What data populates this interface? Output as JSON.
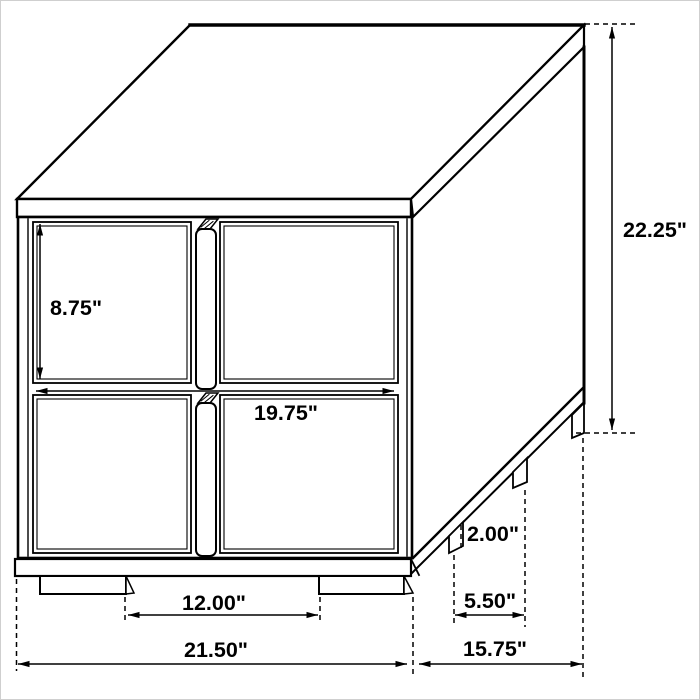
{
  "drawing": {
    "subject": "Two-drawer nightstand isometric dimension drawing",
    "units": "inches",
    "line_color": "#000000",
    "background_color": "#ffffff"
  },
  "labels": {
    "drawer_height": "8.75\"",
    "drawer_width": "19.75\"",
    "overall_height": "22.25\"",
    "front_leg_spacing": "12.00\"",
    "overall_width": "21.50\"",
    "overall_depth": "15.75\"",
    "side_leg_spacing": "5.50\"",
    "leg_height": "2.00\""
  }
}
